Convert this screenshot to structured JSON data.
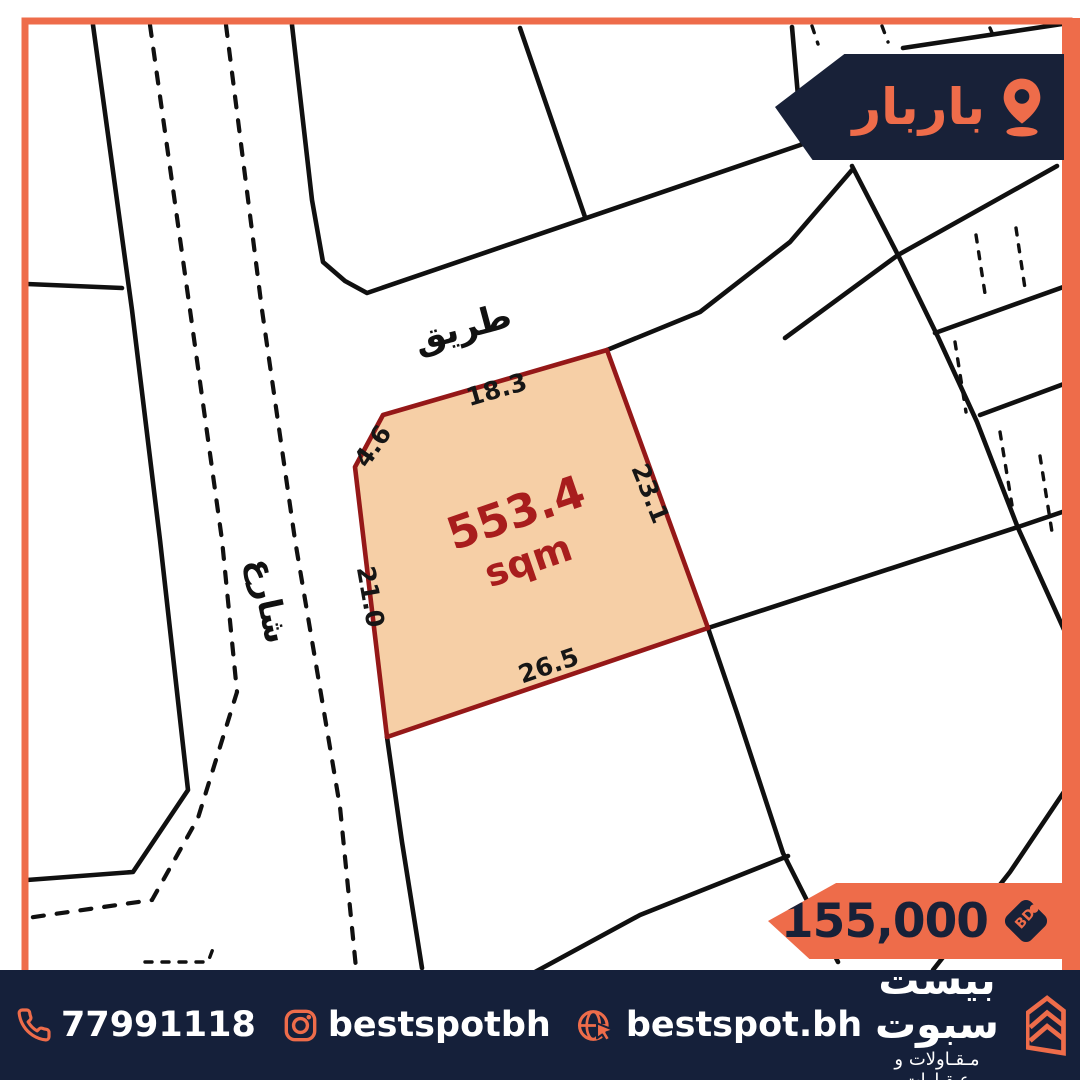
{
  "location_banner": {
    "label": "باربار"
  },
  "map": {
    "road_label_top": "طريق",
    "road_label_left": "شارع",
    "plot": {
      "area_value": "553.4",
      "area_unit": "sqm",
      "dimensions": {
        "top": "18.3",
        "top_left": "4.6",
        "right": "23.1",
        "left": "21.0",
        "bottom": "26.5"
      }
    }
  },
  "price_banner": {
    "amount": "155,000",
    "currency": "BD"
  },
  "footer": {
    "phone": "77991118",
    "instagram": "bestspotbh",
    "website": "bestspot.bh",
    "brand_name": "بيست سبوت",
    "brand_tagline": "مـقـاولات و عـقـارات"
  },
  "colors": {
    "orange": "#ee6c4a",
    "navy": "#182138",
    "plot_fill": "#f6cfa6",
    "plot_border": "#951818",
    "area_text": "#a81d1d",
    "map_line": "#101010"
  }
}
